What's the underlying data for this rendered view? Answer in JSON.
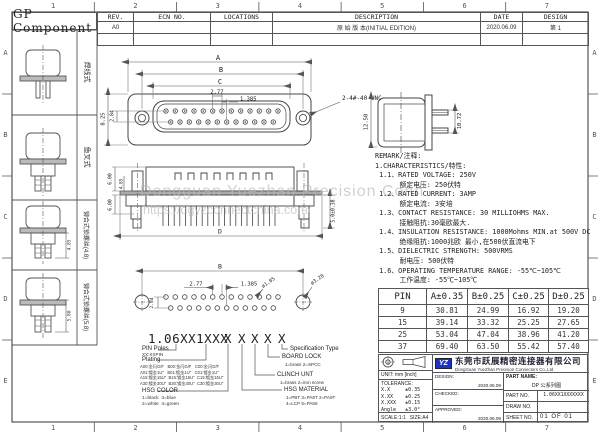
{
  "sheet": {
    "title": "GP Component",
    "watermark_line1": "Dongguan Yuezhan Precision Conn",
    "watermark_line2": "https://dgyzconnectchina.com/"
  },
  "border": {
    "cols": [
      "1",
      "2",
      "3",
      "4",
      "5",
      "6",
      "7"
    ],
    "rows": [
      "A",
      "B",
      "C",
      "D",
      "E"
    ]
  },
  "revision_table": {
    "headers": {
      "rev": "REV.",
      "ecn": "ECN NO.",
      "locations": "LOCATIONS",
      "description": "DESCRIPTION",
      "date": "DATE",
      "design": "DESIGN"
    },
    "row1": {
      "rev": "A0",
      "ecn": "",
      "locations": "",
      "description": "原 始 版 本(INITIAL EDITION)",
      "date": "2020.06.09",
      "design": "第 1"
    }
  },
  "left_views": {
    "labels": [
      "焊线式",
      "鱼叉式",
      "铆合式锁螺丝(4.8)",
      "铆合式锁螺丝(5.8)"
    ],
    "dim3": "4.85",
    "dim4": "5.80"
  },
  "front_view": {
    "dim_a": "A",
    "dim_b": "B",
    "dim_c": "C",
    "pitch": "2.77",
    "half_pitch": "1.385",
    "row_height": "8.25",
    "row_gap": "2.84",
    "thread": "2-4#-40 UNC"
  },
  "side_view": {
    "height": "12.50",
    "pin_height": "10.72"
  },
  "mid_view": {
    "d_top": "6.00",
    "d_mid": "4.85",
    "d_bottom": "6.00",
    "d_right": "5.0±0.38",
    "width": "D"
  },
  "bottom_view": {
    "width": "B",
    "row_gap": "2.84",
    "pitch": "2.77",
    "half_pitch": "1.385",
    "hole_small": "ø1.05",
    "hole_big": "ø3.20"
  },
  "remark": {
    "lines": [
      "REMARK/注释:",
      "1.CHARACTERISTICS/特性:",
      " 1.1、RATED VOLTAGE: 250V",
      "      额定电压: 250伏特",
      " 1.2、RATED CURRENT: 3AMP",
      "      额定电流: 3安培",
      " 1.3、CONTACT RESISTANCE: 30 MILLIOHMS MAX.",
      "      接触阻抗:30毫欧最大.",
      " 1.4、INSULATION RESISTANCE: 1000Mohms MIN.at 500V DC",
      "      绝缘阻抗:1000兆欧 最小,在500伏直流电下",
      " 1.5、DIELECTRIC STRENGTH: 500VRMS",
      "      耐电压: 500伏特",
      " 1.6、OPERATING TEMPERATURE RANGE: -55℃~105℃",
      "      工作温度: -55℃~105℃"
    ]
  },
  "pin_table": {
    "headers": [
      "PIN",
      "A±0.35",
      "B±0.25",
      "C±0.25",
      "D±0.25"
    ],
    "rows": [
      [
        "9",
        "30.81",
        "24.99",
        "16.92",
        "19.20"
      ],
      [
        "15",
        "39.14",
        "33.32",
        "25.25",
        "27.65"
      ],
      [
        "25",
        "53.04",
        "47.04",
        "38.96",
        "41.20"
      ],
      [
        "37",
        "69.40",
        "63.50",
        "55.42",
        "57.40"
      ]
    ]
  },
  "part_number": {
    "base": "1.06XX1XXX",
    "xs": [
      "X",
      "X",
      "X",
      "X",
      "X"
    ],
    "pin_poles_label": "PIN Poles",
    "pin_poles_sub": "XX:XXPIN",
    "plating_label": "Plating",
    "plating_codes": "A00:金闪G/F   B00:金闪G/F   C00:金闪G/F\nA01:镀金1U\"   B01:镀金1U\"   C01:镀金1U\"\nA15:镀金15U\"  B15:镀金15U\"  C15:镀金15U\"\nA30:镀金30U\"  B30:镀金30U\"  C30:镀金30U\"",
    "hsg_color_label": "HSG COLOR",
    "hsg_color_items": "1=black  3=blue\n2=white  4=green",
    "hsg_material_label": "HSG MATERIAL",
    "hsg_material_items": "1=PBT 3=PA9T 2=PA9T\n4=LCP 5=PA66",
    "clinch_label": "CLINCH UNT",
    "clinch_items": "1=brass  2=iron screw",
    "board_lock_label": "BOARD LOCK",
    "board_lock_items": "1=brass  2=SPCC",
    "spec_label": "Specification Type"
  },
  "title_block": {
    "unit": "UNIT: mm [inch]",
    "tolerance_title": "TOLERANCE:",
    "tolerances": "X.X     ±0.35\nX.XX    ±0.25\nX.XXX   ±0.15\nAngle   ±3.0°",
    "scale": "SCALE:1:1",
    "size": "SIZE:A4",
    "design_label": "DESIGN:",
    "design_value": "2020.06.09",
    "checked_label": "CHECKED:",
    "checked_value": "",
    "approved_label": "APPROVED:",
    "approved_value": "2020.06.09",
    "part_name_label": "PART NAME:",
    "part_name_value": "DP 公系列图",
    "part_no_label": "PART NO.",
    "part_no_value": "1.06XX1XXXXXXX",
    "draw_no_label": "DRAW NO.",
    "draw_no_value": "",
    "sheet_no_label": "SHEET NO.",
    "sheet_no_value": "01 OF 01",
    "company_cn": "东莞市跃展精密连接器有限公司",
    "company_en": "DongGuan YueZhan Precision Connectors Co.,Ltd",
    "logo_text": "YZ"
  }
}
